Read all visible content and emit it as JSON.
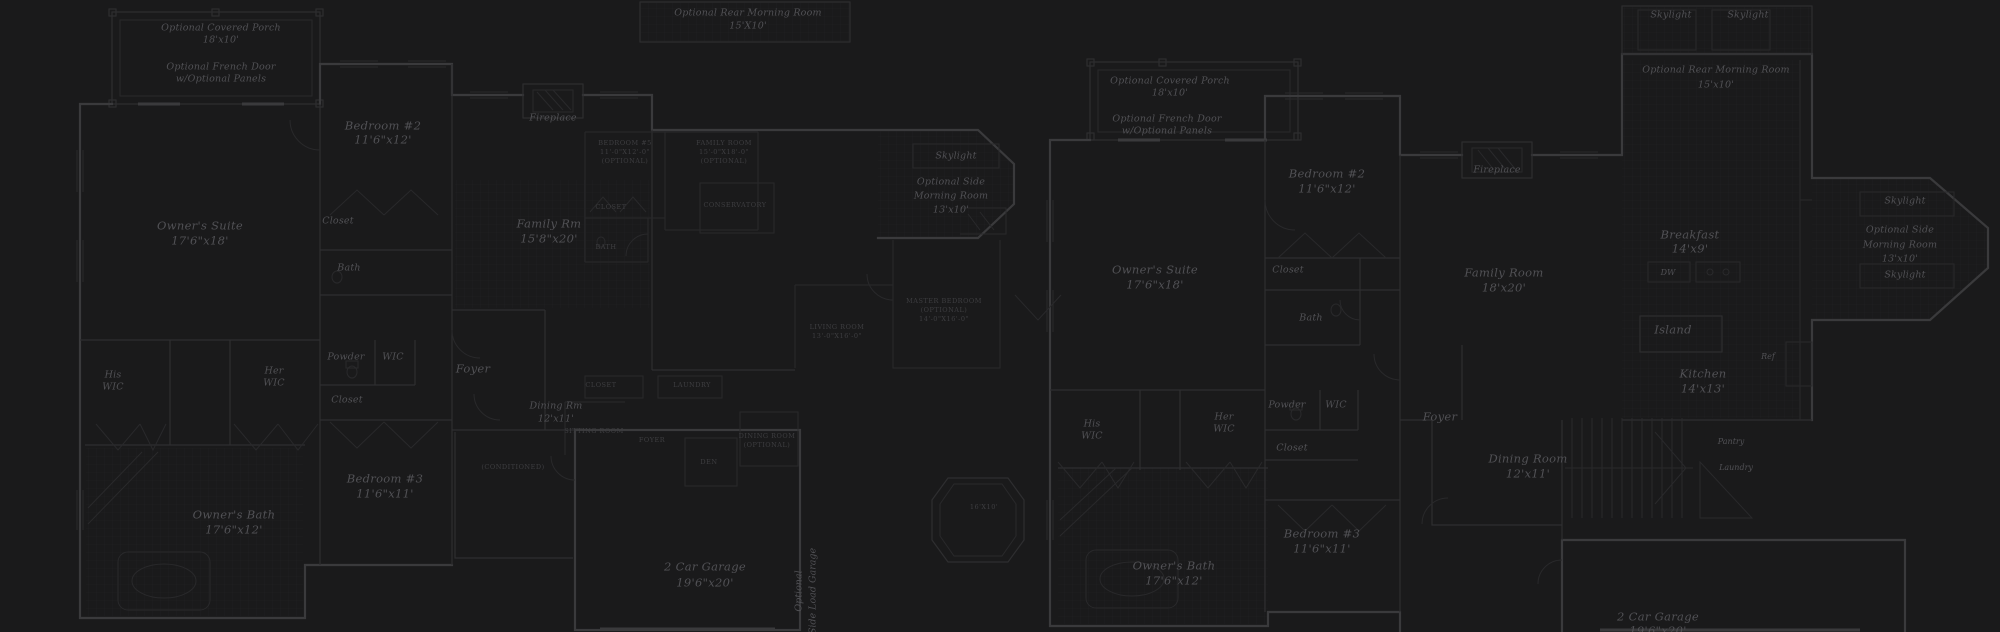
{
  "title": "Dark blueprint sheet with two residential floor plans and optional layouts",
  "colors": {
    "background": "#1a1a1b",
    "walls": "#3a3a3c",
    "walls_light": "#2e2e30",
    "fixture": "#29292b",
    "tile_line": "#222124",
    "text": "#515155",
    "text_dim": "#3e3e41"
  },
  "labels": [
    {
      "name": "label-left-porch-title",
      "text": "Optional Covered Porch",
      "x": 221,
      "y": 28,
      "cls": "s"
    },
    {
      "name": "label-left-porch-size",
      "text": "18'x10'",
      "x": 221,
      "y": 40,
      "cls": "s"
    },
    {
      "name": "label-left-french-door",
      "text": "Optional French Door",
      "x": 221,
      "y": 67,
      "cls": "s"
    },
    {
      "name": "label-left-french-door-panels",
      "text": "w/Optional Panels",
      "x": 221,
      "y": 79,
      "cls": "s"
    },
    {
      "name": "label-left-bedroom2",
      "text": "Bedroom #2",
      "x": 383,
      "y": 126,
      "cls": "r"
    },
    {
      "name": "label-left-bedroom2-size",
      "text": "11'6\"x12'",
      "x": 383,
      "y": 140,
      "cls": "r"
    },
    {
      "name": "label-left-owners-suite",
      "text": "Owner's Suite",
      "x": 200,
      "y": 226,
      "cls": "r"
    },
    {
      "name": "label-left-owners-suite-size",
      "text": "17'6\"x18'",
      "x": 200,
      "y": 241,
      "cls": "r"
    },
    {
      "name": "label-left-fireplace",
      "text": "Fireplace",
      "x": 553,
      "y": 118,
      "cls": "s"
    },
    {
      "name": "label-left-family-rm",
      "text": "Family Rm",
      "x": 549,
      "y": 224,
      "cls": "r"
    },
    {
      "name": "label-left-family-rm-size",
      "text": "15'8\"x20'",
      "x": 549,
      "y": 239,
      "cls": "r"
    },
    {
      "name": "label-left-bed2-closet",
      "text": "Closet",
      "x": 338,
      "y": 221,
      "cls": "s"
    },
    {
      "name": "label-left-bed2-bath",
      "text": "Bath",
      "x": 349,
      "y": 268,
      "cls": "s"
    },
    {
      "name": "label-left-powder",
      "text": "Powder",
      "x": 346,
      "y": 357,
      "cls": "s"
    },
    {
      "name": "label-left-wic",
      "text": "WIC",
      "x": 393,
      "y": 357,
      "cls": "s"
    },
    {
      "name": "label-left-hall-closet",
      "text": "Closet",
      "x": 347,
      "y": 400,
      "cls": "s"
    },
    {
      "name": "label-left-her",
      "text": "Her",
      "x": 274,
      "y": 371,
      "cls": "s"
    },
    {
      "name": "label-left-her-wic",
      "text": "WIC",
      "x": 274,
      "y": 383,
      "cls": "s"
    },
    {
      "name": "label-left-his",
      "text": "His",
      "x": 113,
      "y": 375,
      "cls": "s"
    },
    {
      "name": "label-left-his-wic",
      "text": "WIC",
      "x": 113,
      "y": 387,
      "cls": "s"
    },
    {
      "name": "label-left-foyer",
      "text": "Foyer",
      "x": 473,
      "y": 369,
      "cls": "r"
    },
    {
      "name": "label-left-dining",
      "text": "Dining Rm",
      "x": 556,
      "y": 406,
      "cls": "s"
    },
    {
      "name": "label-left-dining-size",
      "text": "12'x11'",
      "x": 556,
      "y": 419,
      "cls": "s"
    },
    {
      "name": "label-left-bedroom3",
      "text": "Bedroom #3",
      "x": 385,
      "y": 479,
      "cls": "r"
    },
    {
      "name": "label-left-bedroom3-size",
      "text": "11'6\"x11'",
      "x": 385,
      "y": 494,
      "cls": "r"
    },
    {
      "name": "label-left-owners-bath",
      "text": "Owner's Bath",
      "x": 234,
      "y": 515,
      "cls": "r"
    },
    {
      "name": "label-left-owners-bath-size",
      "text": "17'6\"x12'",
      "x": 234,
      "y": 530,
      "cls": "r"
    },
    {
      "name": "label-left-garage",
      "text": "2 Car Garage",
      "x": 705,
      "y": 567,
      "cls": "r"
    },
    {
      "name": "label-left-garage-size",
      "text": "19'6\"x20'",
      "x": 705,
      "y": 583,
      "cls": "r"
    },
    {
      "name": "label-left-sideload-1",
      "text": "Optional",
      "x": 799,
      "y": 591,
      "cls": "v"
    },
    {
      "name": "label-left-sideload-2",
      "text": "Side Load Garage",
      "x": 813,
      "y": 591,
      "cls": "v"
    },
    {
      "name": "label-left-rear-morning",
      "text": "Optional Rear Morning Room",
      "x": 748,
      "y": 13,
      "cls": "s"
    },
    {
      "name": "label-left-rear-morning-size",
      "text": "15'X10'",
      "x": 748,
      "y": 26,
      "cls": "s"
    },
    {
      "name": "label-left-skylight",
      "text": "Skylight",
      "x": 956,
      "y": 156,
      "cls": "s"
    },
    {
      "name": "label-left-side-morning-1",
      "text": "Optional Side",
      "x": 951,
      "y": 182,
      "cls": "s"
    },
    {
      "name": "label-left-side-morning-2",
      "text": "Morning Room",
      "x": 951,
      "y": 196,
      "cls": "s"
    },
    {
      "name": "label-left-side-morning-size",
      "text": "13'x10'",
      "x": 951,
      "y": 210,
      "cls": "s"
    },
    {
      "name": "label-inset-bedroom5",
      "text": "BEDROOM #5",
      "x": 625,
      "y": 143,
      "cls": "t"
    },
    {
      "name": "label-inset-bedroom5-size",
      "text": "11'-0\"X12'-0\"",
      "x": 625,
      "y": 152,
      "cls": "t"
    },
    {
      "name": "label-inset-bedroom5-opt",
      "text": "(OPTIONAL)",
      "x": 625,
      "y": 161,
      "cls": "t"
    },
    {
      "name": "label-inset-familyroom",
      "text": "FAMILY ROOM",
      "x": 724,
      "y": 143,
      "cls": "t"
    },
    {
      "name": "label-inset-familyroom-size",
      "text": "15'-0\"X18'-0\"",
      "x": 724,
      "y": 152,
      "cls": "t"
    },
    {
      "name": "label-inset-familyroom-opt",
      "text": "(OPTIONAL)",
      "x": 724,
      "y": 161,
      "cls": "t"
    },
    {
      "name": "label-inset-closet-1",
      "text": "CLOSET",
      "x": 611,
      "y": 207,
      "cls": "t"
    },
    {
      "name": "label-inset-bath",
      "text": "BATH",
      "x": 606,
      "y": 247,
      "cls": "t"
    },
    {
      "name": "label-inset-conservatory",
      "text": "CONSERVATORY",
      "x": 735,
      "y": 205,
      "cls": "t"
    },
    {
      "name": "label-inset-living-room",
      "text": "LIVING ROOM",
      "x": 837,
      "y": 327,
      "cls": "t"
    },
    {
      "name": "label-inset-living-room-size",
      "text": "13'-0\"X16'-0\"",
      "x": 837,
      "y": 336,
      "cls": "t"
    },
    {
      "name": "label-inset-master-bedroom",
      "text": "MASTER BEDROOM",
      "x": 944,
      "y": 301,
      "cls": "t"
    },
    {
      "name": "label-inset-master-opt",
      "text": "(OPTIONAL)",
      "x": 944,
      "y": 310,
      "cls": "t"
    },
    {
      "name": "label-inset-master-size",
      "text": "14'-0\"X16'-0\"",
      "x": 944,
      "y": 319,
      "cls": "t"
    },
    {
      "name": "label-inset-closet-2",
      "text": "CLOSET",
      "x": 601,
      "y": 385,
      "cls": "t"
    },
    {
      "name": "label-inset-laundry",
      "text": "LAUNDRY",
      "x": 692,
      "y": 385,
      "cls": "t"
    },
    {
      "name": "label-inset-sitting-room",
      "text": "SITTING ROOM",
      "x": 594,
      "y": 431,
      "cls": "t"
    },
    {
      "name": "label-inset-foyer",
      "text": "FOYER",
      "x": 652,
      "y": 440,
      "cls": "t"
    },
    {
      "name": "label-inset-den",
      "text": "DEN",
      "x": 709,
      "y": 462,
      "cls": "t"
    },
    {
      "name": "label-inset-dining",
      "text": "DINING ROOM",
      "x": 767,
      "y": 436,
      "cls": "t"
    },
    {
      "name": "label-inset-dining-opt",
      "text": "(OPTIONAL)",
      "x": 767,
      "y": 445,
      "cls": "t"
    },
    {
      "name": "label-inset-conditioned",
      "text": "(CONDITIONED)",
      "x": 513,
      "y": 467,
      "cls": "t"
    },
    {
      "name": "label-inset-turret-size",
      "text": "16'X10'",
      "x": 984,
      "y": 507,
      "cls": "t"
    },
    {
      "name": "label-right-porch-title",
      "text": "Optional Covered Porch",
      "x": 1170,
      "y": 81,
      "cls": "s"
    },
    {
      "name": "label-right-porch-size",
      "text": "18'x10'",
      "x": 1170,
      "y": 93,
      "cls": "s"
    },
    {
      "name": "label-right-french-door",
      "text": "Optional French Door",
      "x": 1167,
      "y": 119,
      "cls": "s"
    },
    {
      "name": "label-right-french-door-panels",
      "text": "w/Optional Panels",
      "x": 1167,
      "y": 131,
      "cls": "s"
    },
    {
      "name": "label-right-bedroom2",
      "text": "Bedroom #2",
      "x": 1327,
      "y": 174,
      "cls": "r"
    },
    {
      "name": "label-right-bedroom2-size",
      "text": "11'6\"x12'",
      "x": 1327,
      "y": 189,
      "cls": "r"
    },
    {
      "name": "label-right-fireplace",
      "text": "Fireplace",
      "x": 1497,
      "y": 170,
      "cls": "s"
    },
    {
      "name": "label-right-owners-suite",
      "text": "Owner's Suite",
      "x": 1155,
      "y": 270,
      "cls": "r"
    },
    {
      "name": "label-right-owners-suite-size",
      "text": "17'6\"x18'",
      "x": 1155,
      "y": 285,
      "cls": "r"
    },
    {
      "name": "label-right-family-room",
      "text": "Family Room",
      "x": 1504,
      "y": 273,
      "cls": "r"
    },
    {
      "name": "label-right-family-room-size",
      "text": "18'x20'",
      "x": 1504,
      "y": 288,
      "cls": "r"
    },
    {
      "name": "label-right-breakfast",
      "text": "Breakfast",
      "x": 1690,
      "y": 235,
      "cls": "r"
    },
    {
      "name": "label-right-breakfast-size",
      "text": "14'x9'",
      "x": 1690,
      "y": 249,
      "cls": "r"
    },
    {
      "name": "label-right-dw",
      "text": "DW",
      "x": 1668,
      "y": 273,
      "cls": "xs"
    },
    {
      "name": "label-right-island",
      "text": "Island",
      "x": 1673,
      "y": 330,
      "cls": "r"
    },
    {
      "name": "label-right-kitchen",
      "text": "Kitchen",
      "x": 1703,
      "y": 374,
      "cls": "r"
    },
    {
      "name": "label-right-kitchen-size",
      "text": "14'x13'",
      "x": 1703,
      "y": 389,
      "cls": "r"
    },
    {
      "name": "label-right-ref",
      "text": "Ref",
      "x": 1768,
      "y": 357,
      "cls": "xs"
    },
    {
      "name": "label-right-skylight-top",
      "text": "Skylight",
      "x": 1905,
      "y": 201,
      "cls": "s"
    },
    {
      "name": "label-right-side-morning-1",
      "text": "Optional Side",
      "x": 1900,
      "y": 230,
      "cls": "s"
    },
    {
      "name": "label-right-side-morning-2",
      "text": "Morning Room",
      "x": 1900,
      "y": 245,
      "cls": "s"
    },
    {
      "name": "label-right-side-morning-size",
      "text": "13'x10'",
      "x": 1900,
      "y": 259,
      "cls": "s"
    },
    {
      "name": "label-right-skylight-bottom",
      "text": "Skylight",
      "x": 1905,
      "y": 275,
      "cls": "s"
    },
    {
      "name": "label-right-bed2-closet",
      "text": "Closet",
      "x": 1288,
      "y": 270,
      "cls": "s"
    },
    {
      "name": "label-right-bed2-bath",
      "text": "Bath",
      "x": 1311,
      "y": 318,
      "cls": "s"
    },
    {
      "name": "label-right-powder",
      "text": "Powder",
      "x": 1287,
      "y": 405,
      "cls": "s"
    },
    {
      "name": "label-right-wic",
      "text": "WIC",
      "x": 1336,
      "y": 405,
      "cls": "s"
    },
    {
      "name": "label-right-hall-closet",
      "text": "Closet",
      "x": 1292,
      "y": 448,
      "cls": "s"
    },
    {
      "name": "label-right-her",
      "text": "Her",
      "x": 1224,
      "y": 417,
      "cls": "s"
    },
    {
      "name": "label-right-her-wic",
      "text": "WIC",
      "x": 1224,
      "y": 429,
      "cls": "s"
    },
    {
      "name": "label-right-his",
      "text": "His",
      "x": 1092,
      "y": 424,
      "cls": "s"
    },
    {
      "name": "label-right-his-wic",
      "text": "WIC",
      "x": 1092,
      "y": 436,
      "cls": "s"
    },
    {
      "name": "label-right-foyer",
      "text": "Foyer",
      "x": 1440,
      "y": 417,
      "cls": "r"
    },
    {
      "name": "label-right-dining",
      "text": "Dining Room",
      "x": 1528,
      "y": 459,
      "cls": "r"
    },
    {
      "name": "label-right-dining-size",
      "text": "12'x11'",
      "x": 1528,
      "y": 474,
      "cls": "r"
    },
    {
      "name": "label-right-pantry",
      "text": "Pantry",
      "x": 1731,
      "y": 442,
      "cls": "xs"
    },
    {
      "name": "label-right-laundry",
      "text": "Laundry",
      "x": 1736,
      "y": 468,
      "cls": "xs"
    },
    {
      "name": "label-right-bedroom3",
      "text": "Bedroom #3",
      "x": 1322,
      "y": 534,
      "cls": "r"
    },
    {
      "name": "label-right-bedroom3-size",
      "text": "11'6\"x11'",
      "x": 1322,
      "y": 549,
      "cls": "r"
    },
    {
      "name": "label-right-owners-bath",
      "text": "Owner's Bath",
      "x": 1174,
      "y": 566,
      "cls": "r"
    },
    {
      "name": "label-right-owners-bath-size",
      "text": "17'6\"x12'",
      "x": 1174,
      "y": 581,
      "cls": "r"
    },
    {
      "name": "label-right-garage",
      "text": "2 Car Garage",
      "x": 1658,
      "y": 617,
      "cls": "r"
    },
    {
      "name": "label-right-garage-size",
      "text": "19'6\"x20'",
      "x": 1658,
      "y": 631,
      "cls": "r"
    },
    {
      "name": "label-right-skylight-rear-1",
      "text": "Skylight",
      "x": 1671,
      "y": 15,
      "cls": "s"
    },
    {
      "name": "label-right-skylight-rear-2",
      "text": "Skylight",
      "x": 1748,
      "y": 15,
      "cls": "s"
    },
    {
      "name": "label-right-rear-morning",
      "text": "Optional Rear Morning Room",
      "x": 1716,
      "y": 70,
      "cls": "s"
    },
    {
      "name": "label-right-rear-morning-size",
      "text": "15'x10'",
      "x": 1716,
      "y": 85,
      "cls": "s"
    }
  ]
}
